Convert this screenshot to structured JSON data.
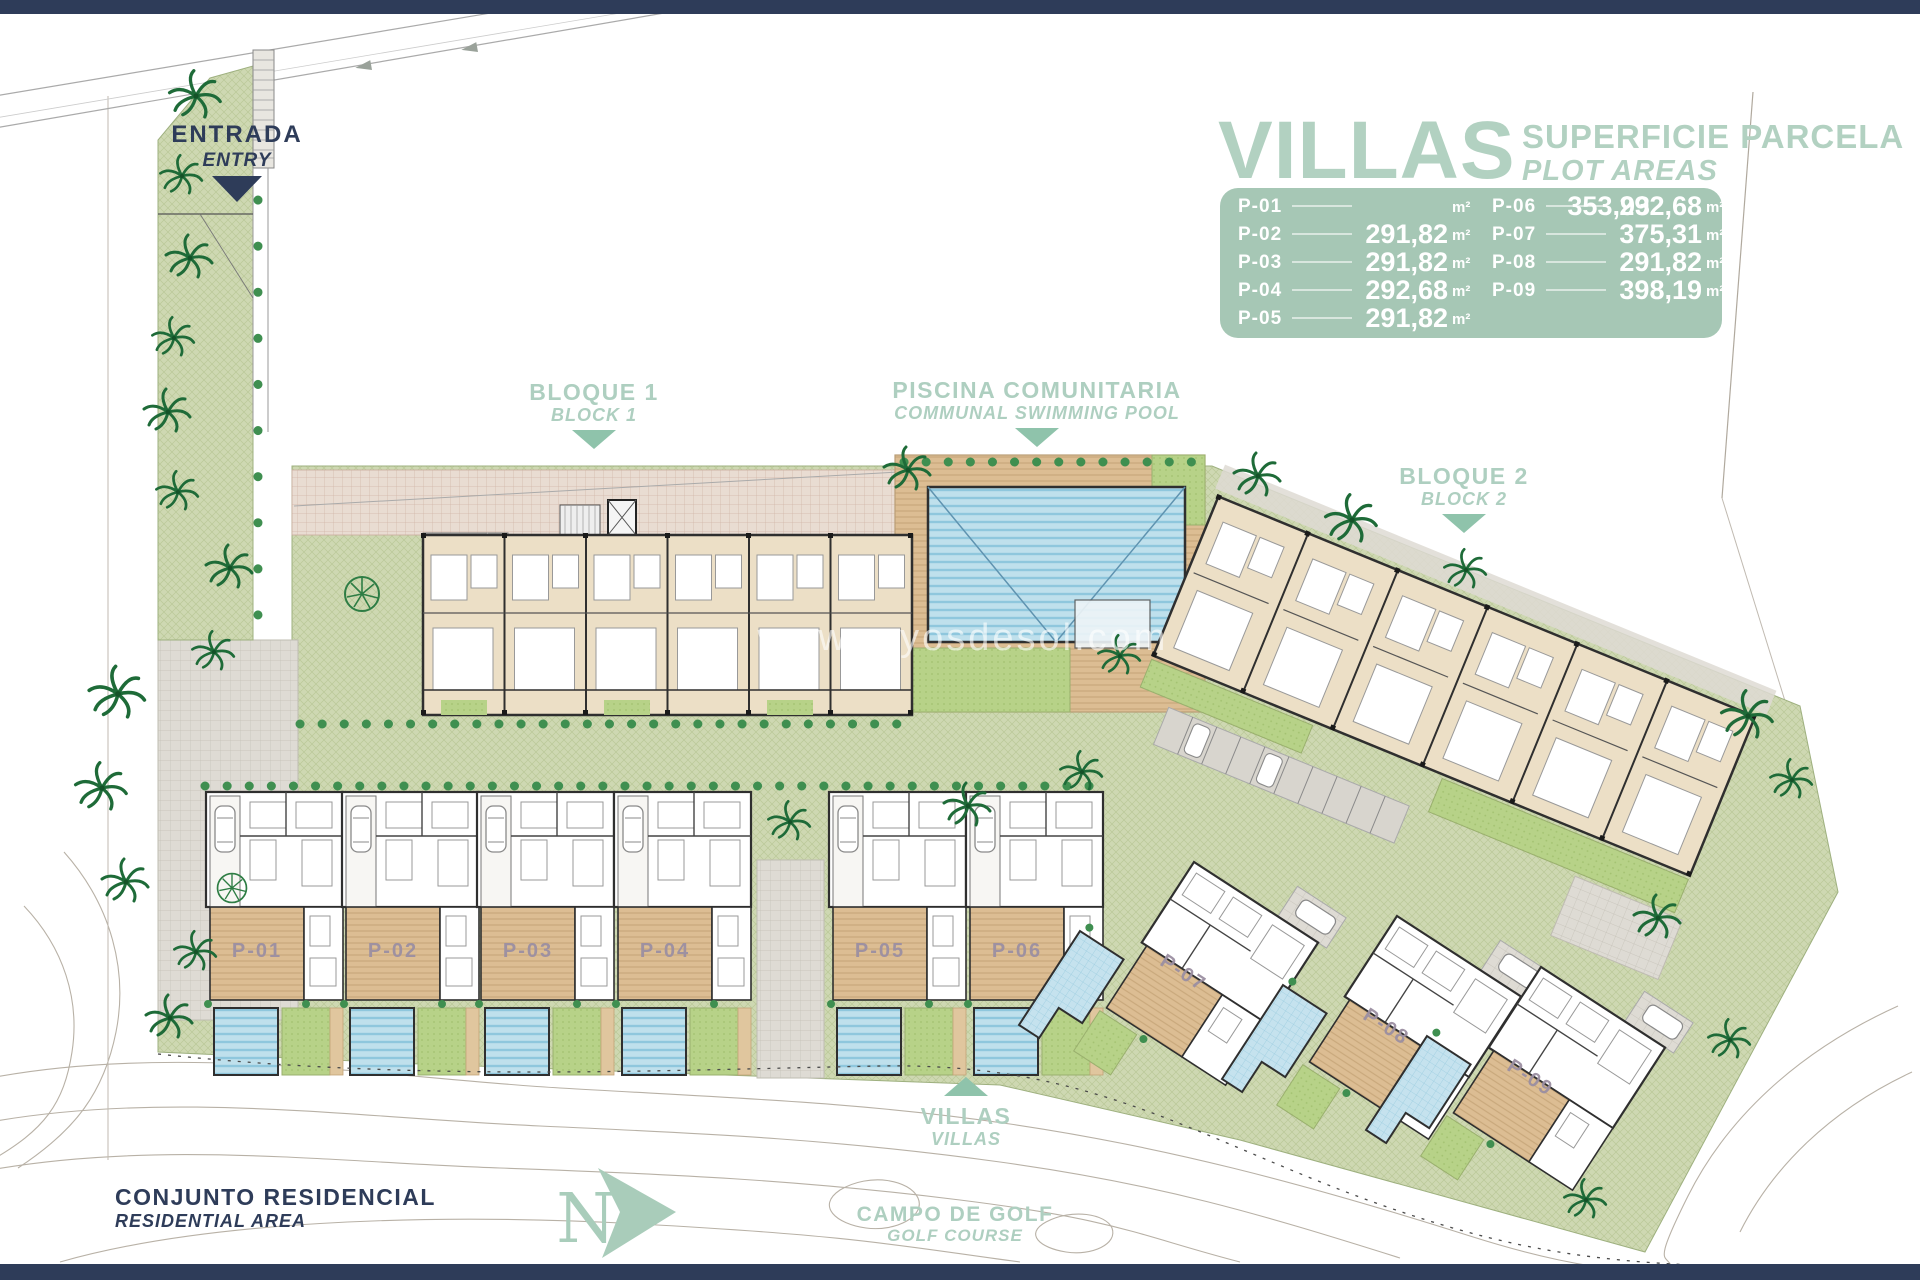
{
  "legend": {
    "title": "VILLAS",
    "subtitle": "SUPERFICIE PARCELA",
    "subtitle_en": "PLOT AREAS",
    "unit": "m²",
    "panel_color": "#a6c7b5",
    "text_color": "#ffffff",
    "rows": [
      {
        "plot": "P-01",
        "area": "353,93"
      },
      {
        "plot": "P-02",
        "area": "291,82"
      },
      {
        "plot": "P-03",
        "area": "291,82"
      },
      {
        "plot": "P-04",
        "area": "292,68"
      },
      {
        "plot": "P-05",
        "area": "291,82"
      },
      {
        "plot": "P-06",
        "area": "292,68"
      },
      {
        "plot": "P-07",
        "area": "375,31"
      },
      {
        "plot": "P-08",
        "area": "291,82"
      },
      {
        "plot": "P-09",
        "area": "398,19"
      }
    ]
  },
  "labels": {
    "entrance": {
      "es": "ENTRADA",
      "en": "ENTRY"
    },
    "block1": {
      "es": "BLOQUE 1",
      "en": "BLOCK 1"
    },
    "communal_pool": {
      "es": "PISCINA COMUNITARIA",
      "en": "COMMUNAL SWIMMING POOL"
    },
    "block2": {
      "es": "BLOQUE 2",
      "en": "BLOCK 2"
    },
    "villas_pointer": {
      "es": "VILLAS",
      "en": "VILLAS"
    },
    "residential": {
      "es": "CONJUNTO RESIDENCIAL",
      "en": "RESIDENTIAL AREA"
    },
    "golf": {
      "es": "CAMPO DE GOLF",
      "en": "GOLF COURSE"
    },
    "north": "N",
    "watermark": "www.rayosdesol.com"
  },
  "colors": {
    "navy_bar": "#2e3c59",
    "sage_accent": "#a9cdbb",
    "triangle": "#8fc3ab",
    "green_area": "#ced8b2",
    "deck_tan": "#dcbd93",
    "pool_blue": "#bfe0ec",
    "lawn_green": "#b7d288",
    "building_beige": "#ecdfc6",
    "plot_label": "#9b8fa2"
  }
}
